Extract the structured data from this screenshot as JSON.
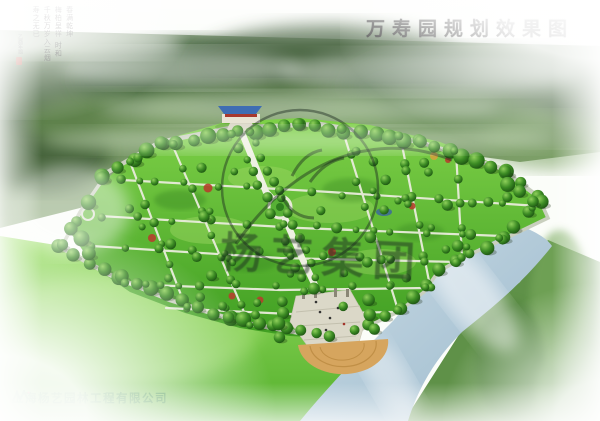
{
  "header": {
    "title": "万寿园规划效果图"
  },
  "inscription": {
    "columns": [
      "春满乾坤",
      "梅柏呈祥 时和",
      "千秋万岁入云烟",
      "寿之无已"
    ],
    "signature": "乙酉年题"
  },
  "watermark": {
    "text": "杨艺集团"
  },
  "footer": {
    "company": "上海杨艺园林工程有限公司"
  },
  "palette": {
    "lawn_green": "#5cb72e",
    "tree_green": "#2d6e1f",
    "river_blue": "#b7cedd",
    "plaza_tan": "#d6a55e",
    "path_light": "#e9ecdb",
    "title_ink": "#181818",
    "company_green": "#157a15",
    "seal_red": "#c03a2b"
  }
}
